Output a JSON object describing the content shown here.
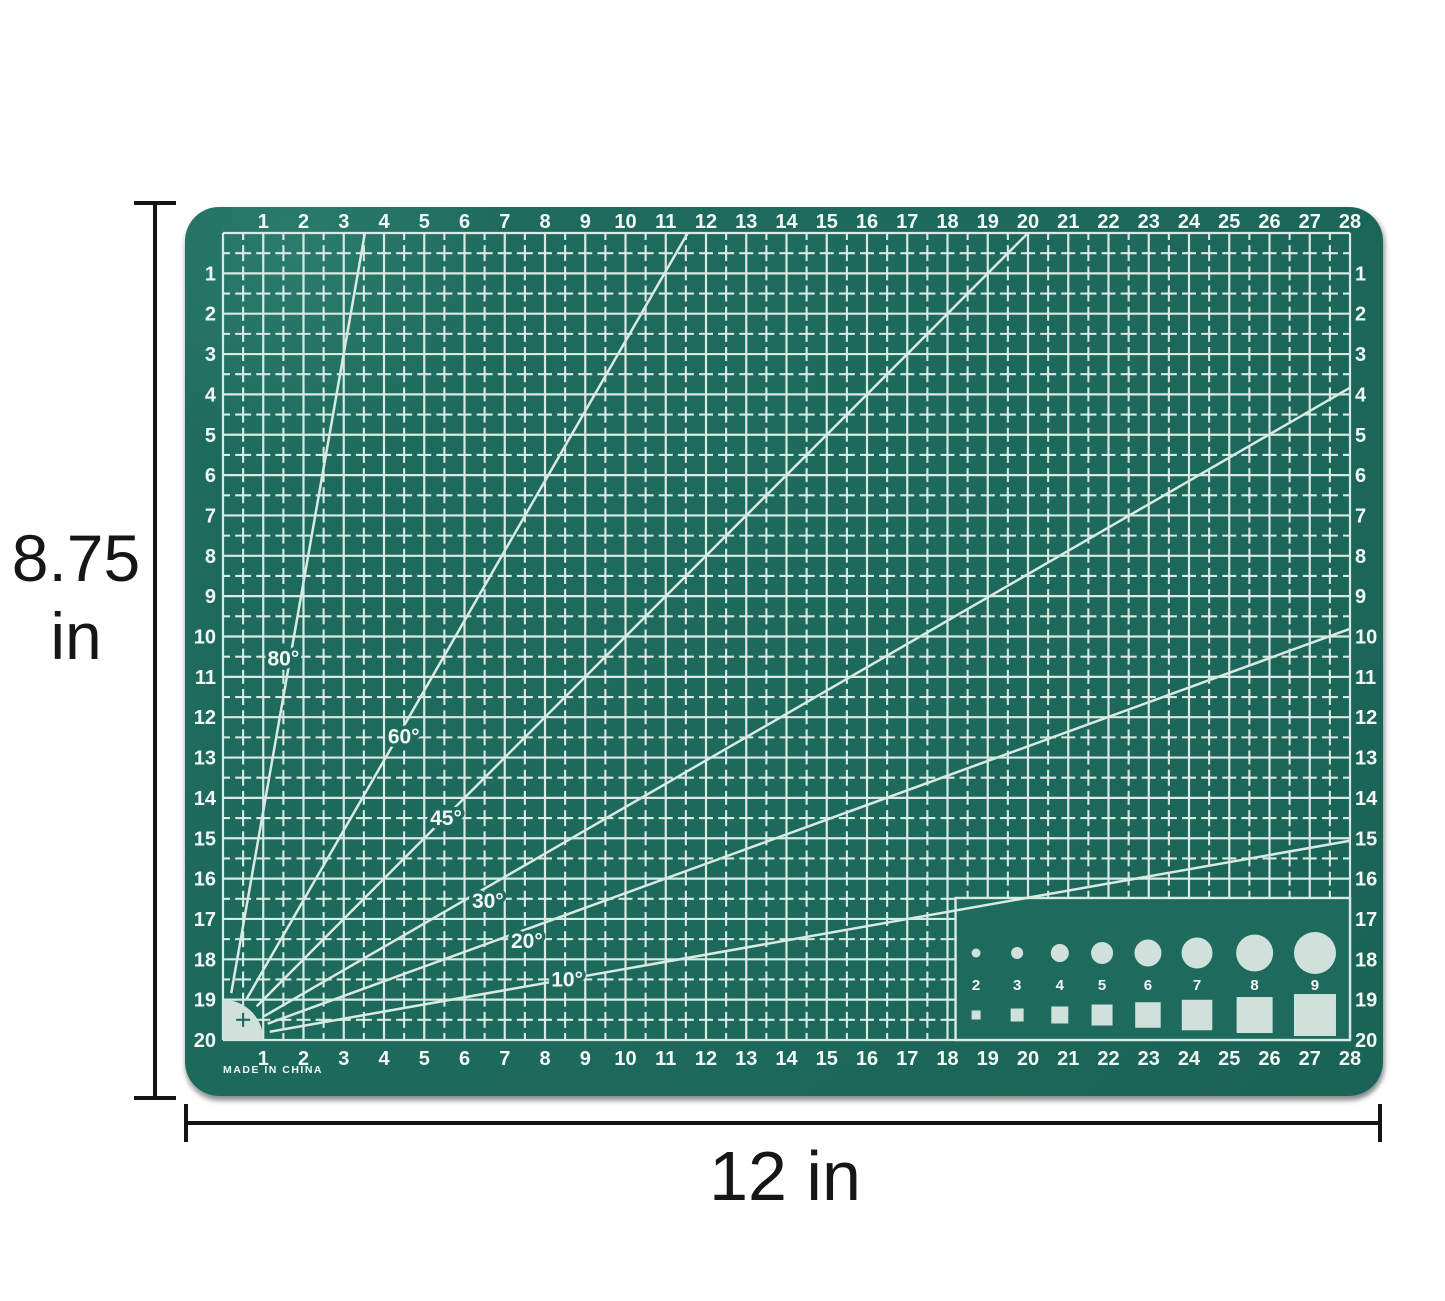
{
  "dimensions": {
    "height_value": "8.75",
    "height_unit": "in",
    "width_text": "12 in"
  },
  "mat": {
    "made_in": "MADE IN CHINA",
    "colors": {
      "surface": "#1e6b5d",
      "grid_line": "#d9e9e3",
      "numeral": "#f2f8f5",
      "shape_fill": "#cfe1da"
    },
    "ruler_top": [
      "1",
      "2",
      "3",
      "4",
      "5",
      "6",
      "7",
      "8",
      "9",
      "10",
      "11",
      "12",
      "13",
      "14",
      "15",
      "16",
      "17",
      "18",
      "19",
      "20",
      "21",
      "22",
      "23",
      "24",
      "25",
      "26",
      "27",
      "28"
    ],
    "ruler_bottom": [
      "1",
      "2",
      "3",
      "4",
      "5",
      "6",
      "7",
      "8",
      "9",
      "10",
      "11",
      "12",
      "13",
      "14",
      "15",
      "16",
      "17",
      "18",
      "19",
      "20",
      "21",
      "22",
      "23",
      "24",
      "25",
      "26",
      "27",
      "28"
    ],
    "ruler_left": [
      "1",
      "2",
      "3",
      "4",
      "5",
      "6",
      "7",
      "8",
      "9",
      "10",
      "11",
      "12",
      "13",
      "14",
      "15",
      "16",
      "17",
      "18",
      "19",
      "20"
    ],
    "ruler_right": [
      "1",
      "2",
      "3",
      "4",
      "5",
      "6",
      "7",
      "8",
      "9",
      "10",
      "11",
      "12",
      "13",
      "14",
      "15",
      "16",
      "17",
      "18",
      "19",
      "20"
    ],
    "angle_lines": [
      {
        "deg": 80,
        "label": "80°",
        "label_x": 1.5,
        "label_y": 10.55
      },
      {
        "deg": 60,
        "label": "60°",
        "label_x": 4.49,
        "label_y": 12.48
      },
      {
        "deg": 45,
        "label": "45°",
        "label_x": 5.54,
        "label_y": 14.5
      },
      {
        "deg": 30,
        "label": "30°",
        "label_x": 6.58,
        "label_y": 16.55
      },
      {
        "deg": 20,
        "label": "20°",
        "label_x": 7.55,
        "label_y": 17.55
      },
      {
        "deg": 10,
        "label": "10°",
        "label_x": 8.55,
        "label_y": 18.5
      }
    ],
    "shape_template": {
      "labels": [
        "2",
        "3",
        "4",
        "5",
        "6",
        "7",
        "8",
        "9"
      ]
    }
  }
}
